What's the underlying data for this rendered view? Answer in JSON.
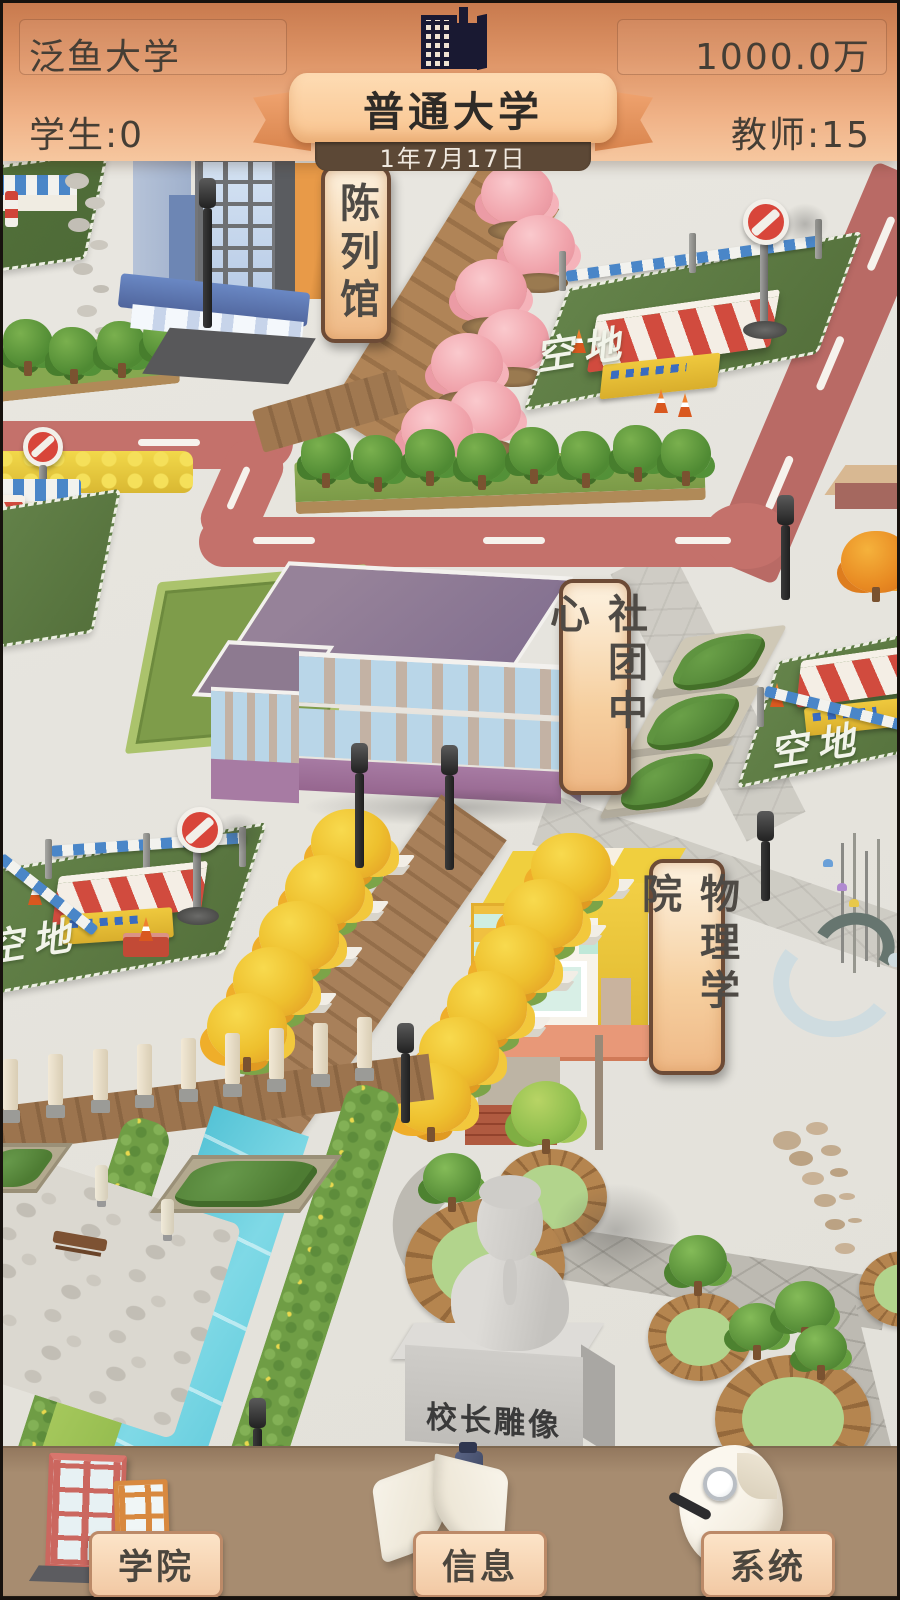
{
  "header": {
    "school_name": "泛鱼大学",
    "funds": "1000.0万",
    "students": "学生:0",
    "teachers": "教师:15",
    "banner_title": "普通大学",
    "date": "1年7月17日"
  },
  "map": {
    "labels": {
      "exhibition_hall": "陈列馆",
      "club_center": "社团中心",
      "physics_college": "物理学院",
      "empty_lot": "空地",
      "statue": "校长雕像"
    }
  },
  "bottom_bar": {
    "buttons": [
      {
        "label": "学院"
      },
      {
        "label": "信息"
      },
      {
        "label": "系统"
      }
    ]
  },
  "icons": {
    "header_building": "dark-building-silhouette",
    "college": "two-school-buildings",
    "info": "open-book-with-ink-bottle",
    "system": "paper-scroll-with-magnifier",
    "no_entry": "no-entry-sign"
  },
  "colors": {
    "header_orange": "#e9a273",
    "ribbon_peach": "#fdd9ae",
    "date_bg": "#5c4836",
    "road_red": "#c4716b",
    "lot_green": "#5e7c40",
    "river_blue": "#63cbdc",
    "bar_brown": "#a78c70",
    "plate_peach": "#f6d4b0",
    "scroll_parchment": "#f8dcb4"
  }
}
